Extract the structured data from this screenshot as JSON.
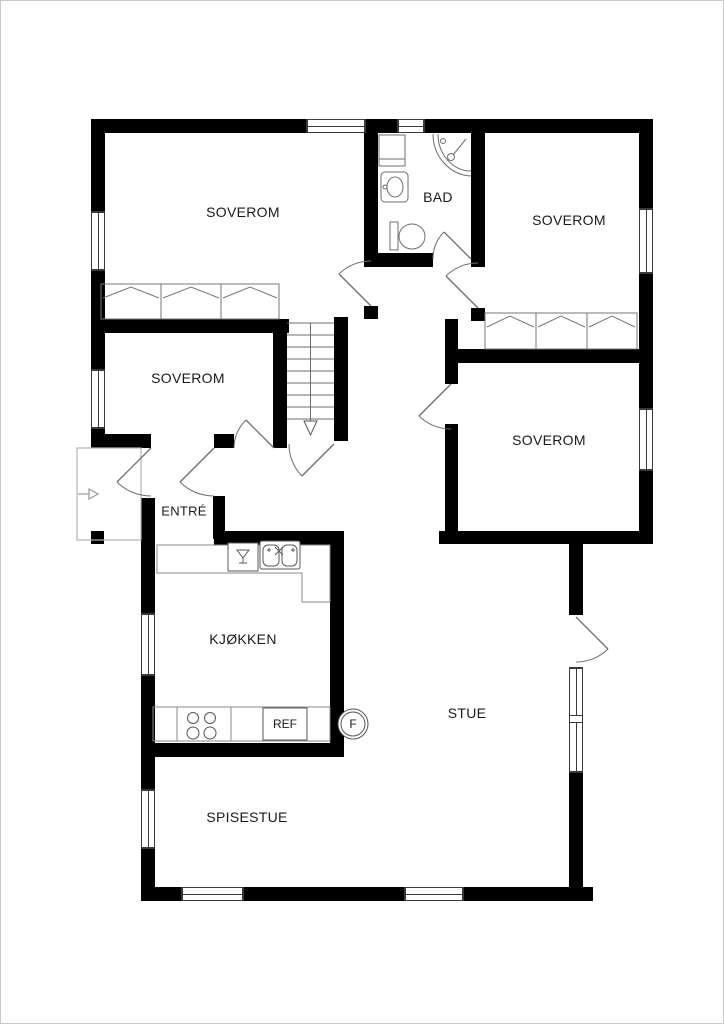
{
  "plan": {
    "labels": {
      "bedroom_tl": "SOVEROM",
      "bath": "BAD",
      "bedroom_tr": "SOVEROM",
      "bedroom_ml": "SOVEROM",
      "bedroom_br": "SOVEROM",
      "entrance": "ENTRÉ",
      "kitchen": "KJØKKEN",
      "living": "STUE",
      "dining": "SPISESTUE",
      "fridge": "REF",
      "fireplace": "F"
    },
    "colors": {
      "wall": "#000000",
      "thin_line": "#6e6e6e",
      "counter_line": "#8a8a8a",
      "porch_line": "#b5b5b5",
      "text": "#1a1a1a",
      "background": "#ffffff"
    }
  }
}
